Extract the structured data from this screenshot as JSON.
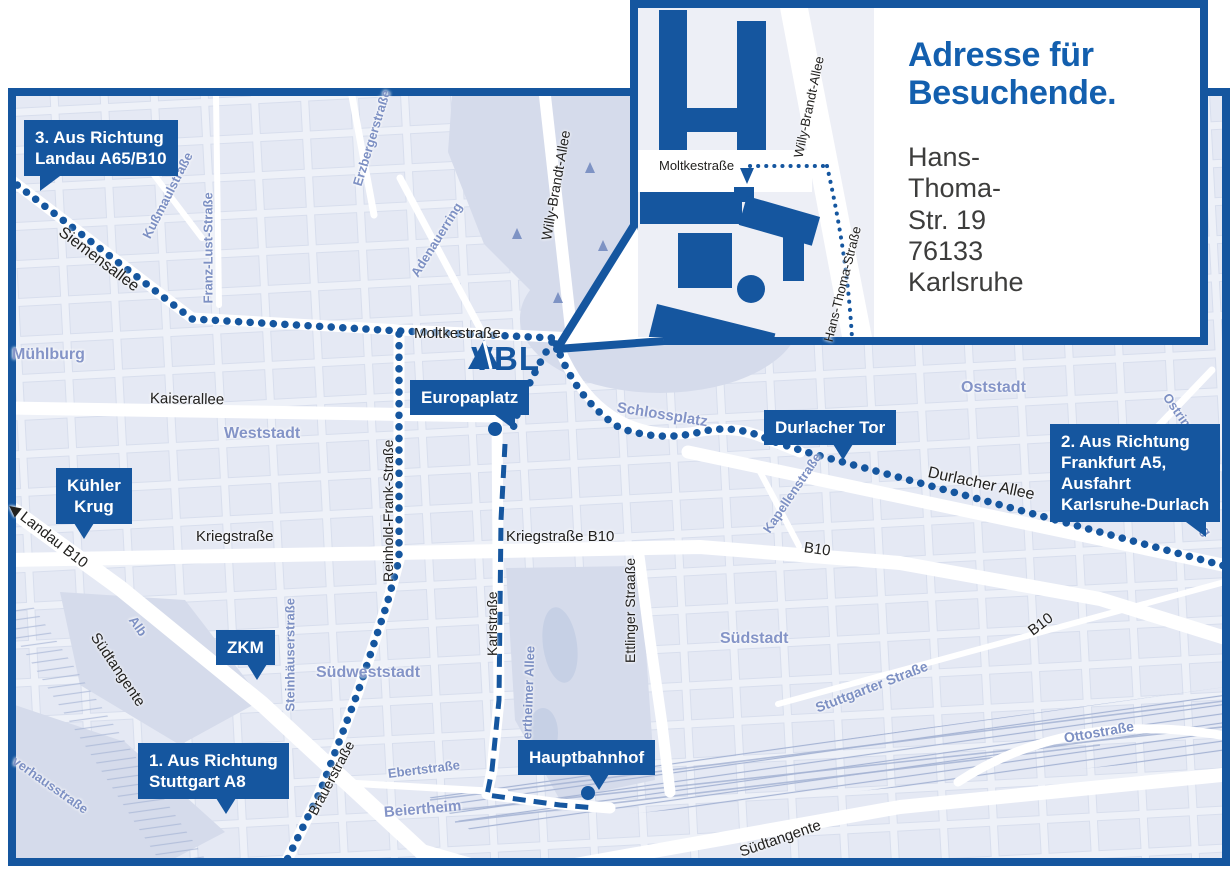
{
  "colors": {
    "accent": "#15569f",
    "heading_blue": "#135fae",
    "dark_text": "#22211f",
    "address_text": "#3d3d3c",
    "area_label": "#8494c7",
    "street_label_blue": "#7d90c3",
    "map_bg": "#eef1f8",
    "block_fill": "#dde3f0",
    "block_stroke": "#c6cfe4",
    "park": "#d5dbeb",
    "water": "#c6d0e5",
    "rail": "#a6b4d4",
    "inset_map_bg": "#edeff6",
    "street_white": "#ffffff"
  },
  "logo": {
    "text": "VBL"
  },
  "inset": {
    "heading": "Adresse für Besuchende.",
    "address_line1": "Hans-Thoma-Str. 19",
    "address_line2": "76133 Karlsruhe"
  },
  "map": {
    "routes": [
      {
        "name": "route-from-landau",
        "style": "dotted"
      },
      {
        "name": "route-from-stuttgart",
        "style": "dotted"
      },
      {
        "name": "route-from-frankfurt",
        "style": "dotted"
      },
      {
        "name": "route-europaplatz-hauptbahnhof",
        "style": "dashed"
      }
    ],
    "stops": [
      {
        "name": "europaplatz-stop"
      },
      {
        "name": "hauptbahnhof-stop"
      }
    ],
    "badges": [
      {
        "name": "richtung-landau",
        "lines": [
          "3. Aus Richtung",
          "Landau A65/B10"
        ],
        "x": 24,
        "y": 120,
        "tail": "bl"
      },
      {
        "name": "kuehler-krug",
        "lines": [
          "Kühler",
          "Krug"
        ],
        "x": 56,
        "y": 468,
        "tail": "b",
        "align": "center"
      },
      {
        "name": "zkm",
        "lines": [
          "ZKM"
        ],
        "x": 216,
        "y": 630,
        "tail": "b2",
        "align": "center"
      },
      {
        "name": "richtung-stuttgart",
        "lines": [
          "1. Aus Richtung",
          "Stuttgart A8"
        ],
        "x": 138,
        "y": 743,
        "tail": "b2"
      },
      {
        "name": "europaplatz",
        "lines": [
          "Europaplatz"
        ],
        "x": 410,
        "y": 380,
        "tail": "br"
      },
      {
        "name": "hauptbahnhof",
        "lines": [
          "Hauptbahnhof"
        ],
        "x": 518,
        "y": 740,
        "tail": "b2"
      },
      {
        "name": "durlacher-tor",
        "lines": [
          "Durlacher Tor"
        ],
        "x": 764,
        "y": 410,
        "tail": "b2"
      },
      {
        "name": "richtung-frankfurt",
        "lines": [
          "2. Aus Richtung",
          "Frankfurt A5,",
          "Ausfahrt",
          "Karlsruhe-Durlach"
        ],
        "x": 1050,
        "y": 424,
        "tail": "br"
      }
    ],
    "labels": [
      {
        "n": "siemensallee",
        "t": "Siemensallee",
        "x": 60,
        "y": 222,
        "r": 37,
        "c": "dark",
        "s": 16
      },
      {
        "n": "kussmaulstrasse",
        "t": "Kußmaulstraße",
        "x": 146,
        "y": 230,
        "r": -63,
        "c": "blue",
        "s": 13
      },
      {
        "n": "franz-lust-strasse",
        "t": "Franz-Lust-Straße",
        "x": 208,
        "y": 296,
        "r": -90,
        "c": "blue",
        "s": 13
      },
      {
        "n": "erzbergerstrasse",
        "t": "Erzbergerstraße",
        "x": 357,
        "y": 178,
        "r": -73,
        "c": "blue",
        "s": 13
      },
      {
        "n": "adenauerring",
        "t": "Adenauerring",
        "x": 414,
        "y": 268,
        "r": -58,
        "c": "blue",
        "s": 13
      },
      {
        "n": "willy-brandt-allee",
        "t": "Willy-Brandt-Allee",
        "x": 546,
        "y": 232,
        "r": -80,
        "c": "dark",
        "s": 14
      },
      {
        "n": "muehlburg",
        "t": "Mühlburg",
        "x": 12,
        "y": 346,
        "r": 0,
        "c": "area",
        "s": 16
      },
      {
        "n": "moltkestrasse",
        "t": "Moltkestraße",
        "x": 414,
        "y": 325,
        "r": 0,
        "c": "dark",
        "s": 15
      },
      {
        "n": "kaiserallee",
        "t": "Kaiserallee",
        "x": 150,
        "y": 390,
        "r": 1,
        "c": "dark",
        "s": 15
      },
      {
        "n": "weststadt",
        "t": "Weststadt",
        "x": 224,
        "y": 425,
        "r": 0,
        "c": "area",
        "s": 16
      },
      {
        "n": "schlossplatz",
        "t": "Schlossplatz",
        "x": 617,
        "y": 399,
        "r": 9,
        "c": "area",
        "s": 15
      },
      {
        "n": "oststadt",
        "t": "Oststadt",
        "x": 961,
        "y": 379,
        "r": 0,
        "c": "area",
        "s": 16
      },
      {
        "n": "ostring-north",
        "t": "Ostring",
        "x": 1166,
        "y": 387,
        "r": 55,
        "c": "blue",
        "s": 13
      },
      {
        "n": "ostring-south",
        "t": "Ostring",
        "x": 1182,
        "y": 489,
        "r": 55,
        "c": "blue",
        "s": 13
      },
      {
        "n": "durlacher-allee",
        "t": "Durlacher Allee",
        "x": 928,
        "y": 464,
        "r": 12,
        "c": "dark",
        "s": 16
      },
      {
        "n": "kapellenstrasse",
        "t": "Kapellenstraße",
        "x": 766,
        "y": 524,
        "r": -56,
        "c": "blue",
        "s": 13
      },
      {
        "n": "landau-b10",
        "t": "◀ Landau B10",
        "x": 10,
        "y": 496,
        "r": 38,
        "c": "dark",
        "s": 15
      },
      {
        "n": "kriegstrasse",
        "t": "Kriegstraße",
        "x": 196,
        "y": 528,
        "r": 0,
        "c": "dark",
        "s": 15
      },
      {
        "n": "kriegstrasse-b10",
        "t": "Kriegstraße B10",
        "x": 506,
        "y": 528,
        "r": 0,
        "c": "dark",
        "s": 15
      },
      {
        "n": "b10-east",
        "t": "B10",
        "x": 804,
        "y": 539,
        "r": 8,
        "c": "dark",
        "s": 15
      },
      {
        "n": "reinhold-frank-strasse",
        "t": "Reinhold-Frank-Straße",
        "x": 388,
        "y": 574,
        "r": -90,
        "c": "dark",
        "s": 14
      },
      {
        "n": "karlstrasse",
        "t": "Karlstraße",
        "x": 492,
        "y": 648,
        "r": -90,
        "c": "dark",
        "s": 14
      },
      {
        "n": "ettlinger-strasse",
        "t": "Ettlinger Straaße",
        "x": 630,
        "y": 655,
        "r": -90,
        "c": "dark",
        "s": 14
      },
      {
        "n": "suedstadt",
        "t": "Südstadt",
        "x": 720,
        "y": 630,
        "r": 0,
        "c": "area",
        "s": 16
      },
      {
        "n": "stuttgarter-strasse",
        "t": "Stuttgarter Straße",
        "x": 816,
        "y": 700,
        "r": -21,
        "c": "blue",
        "s": 14
      },
      {
        "n": "suedtangente-west",
        "t": "Südtangente",
        "x": 94,
        "y": 626,
        "r": 56,
        "c": "dark",
        "s": 15
      },
      {
        "n": "alb",
        "t": "Alb",
        "x": 132,
        "y": 610,
        "r": 55,
        "c": "blue",
        "s": 13
      },
      {
        "n": "steinhaeuserstrasse",
        "t": "Steinhäuserstraße",
        "x": 290,
        "y": 704,
        "r": -90,
        "c": "blue",
        "s": 13
      },
      {
        "n": "suedweststadt",
        "t": "Südweststadt",
        "x": 316,
        "y": 664,
        "r": 0,
        "c": "area",
        "s": 16
      },
      {
        "n": "brauerstrasse",
        "t": "Brauerstraße",
        "x": 312,
        "y": 806,
        "r": -62,
        "c": "dark",
        "s": 14
      },
      {
        "n": "pulverhausstrasse-partial",
        "t": "verhausstraße",
        "x": 14,
        "y": 752,
        "r": 35,
        "c": "blue",
        "s": 13
      },
      {
        "n": "ebertstrasse",
        "t": "Ebertstraße",
        "x": 388,
        "y": 766,
        "r": -7,
        "c": "blue",
        "s": 13
      },
      {
        "n": "beiertheim",
        "t": "Beiertheim",
        "x": 384,
        "y": 804,
        "r": -5,
        "c": "area",
        "s": 15
      },
      {
        "n": "beiertheimer-allee",
        "t": "Beiertheimer Allee",
        "x": 526,
        "y": 752,
        "r": -88,
        "c": "blue",
        "s": 13
      },
      {
        "n": "ottostrasse",
        "t": "Ottostraße",
        "x": 1064,
        "y": 730,
        "r": -10,
        "c": "blue",
        "s": 14
      },
      {
        "n": "b10-southeast",
        "t": "B10",
        "x": 1030,
        "y": 624,
        "r": -37,
        "c": "dark",
        "s": 15
      },
      {
        "n": "suedtangente-south",
        "t": "Südtangente",
        "x": 740,
        "y": 844,
        "r": -19,
        "c": "dark",
        "s": 15
      },
      {
        "n": "inset-moltkestrasse",
        "t": "Moltkestraße",
        "x": 659,
        "y": 158,
        "r": 0,
        "c": "dark",
        "s": 13
      },
      {
        "n": "inset-willy-brandt-allee",
        "t": "Willy-Brandt-Allee",
        "x": 798,
        "y": 150,
        "r": -78,
        "c": "dark",
        "s": 13
      },
      {
        "n": "inset-hans-thoma-strasse",
        "t": "Hans-Thoma-Straße",
        "x": 828,
        "y": 334,
        "r": -76,
        "c": "dark",
        "s": 13
      }
    ]
  }
}
